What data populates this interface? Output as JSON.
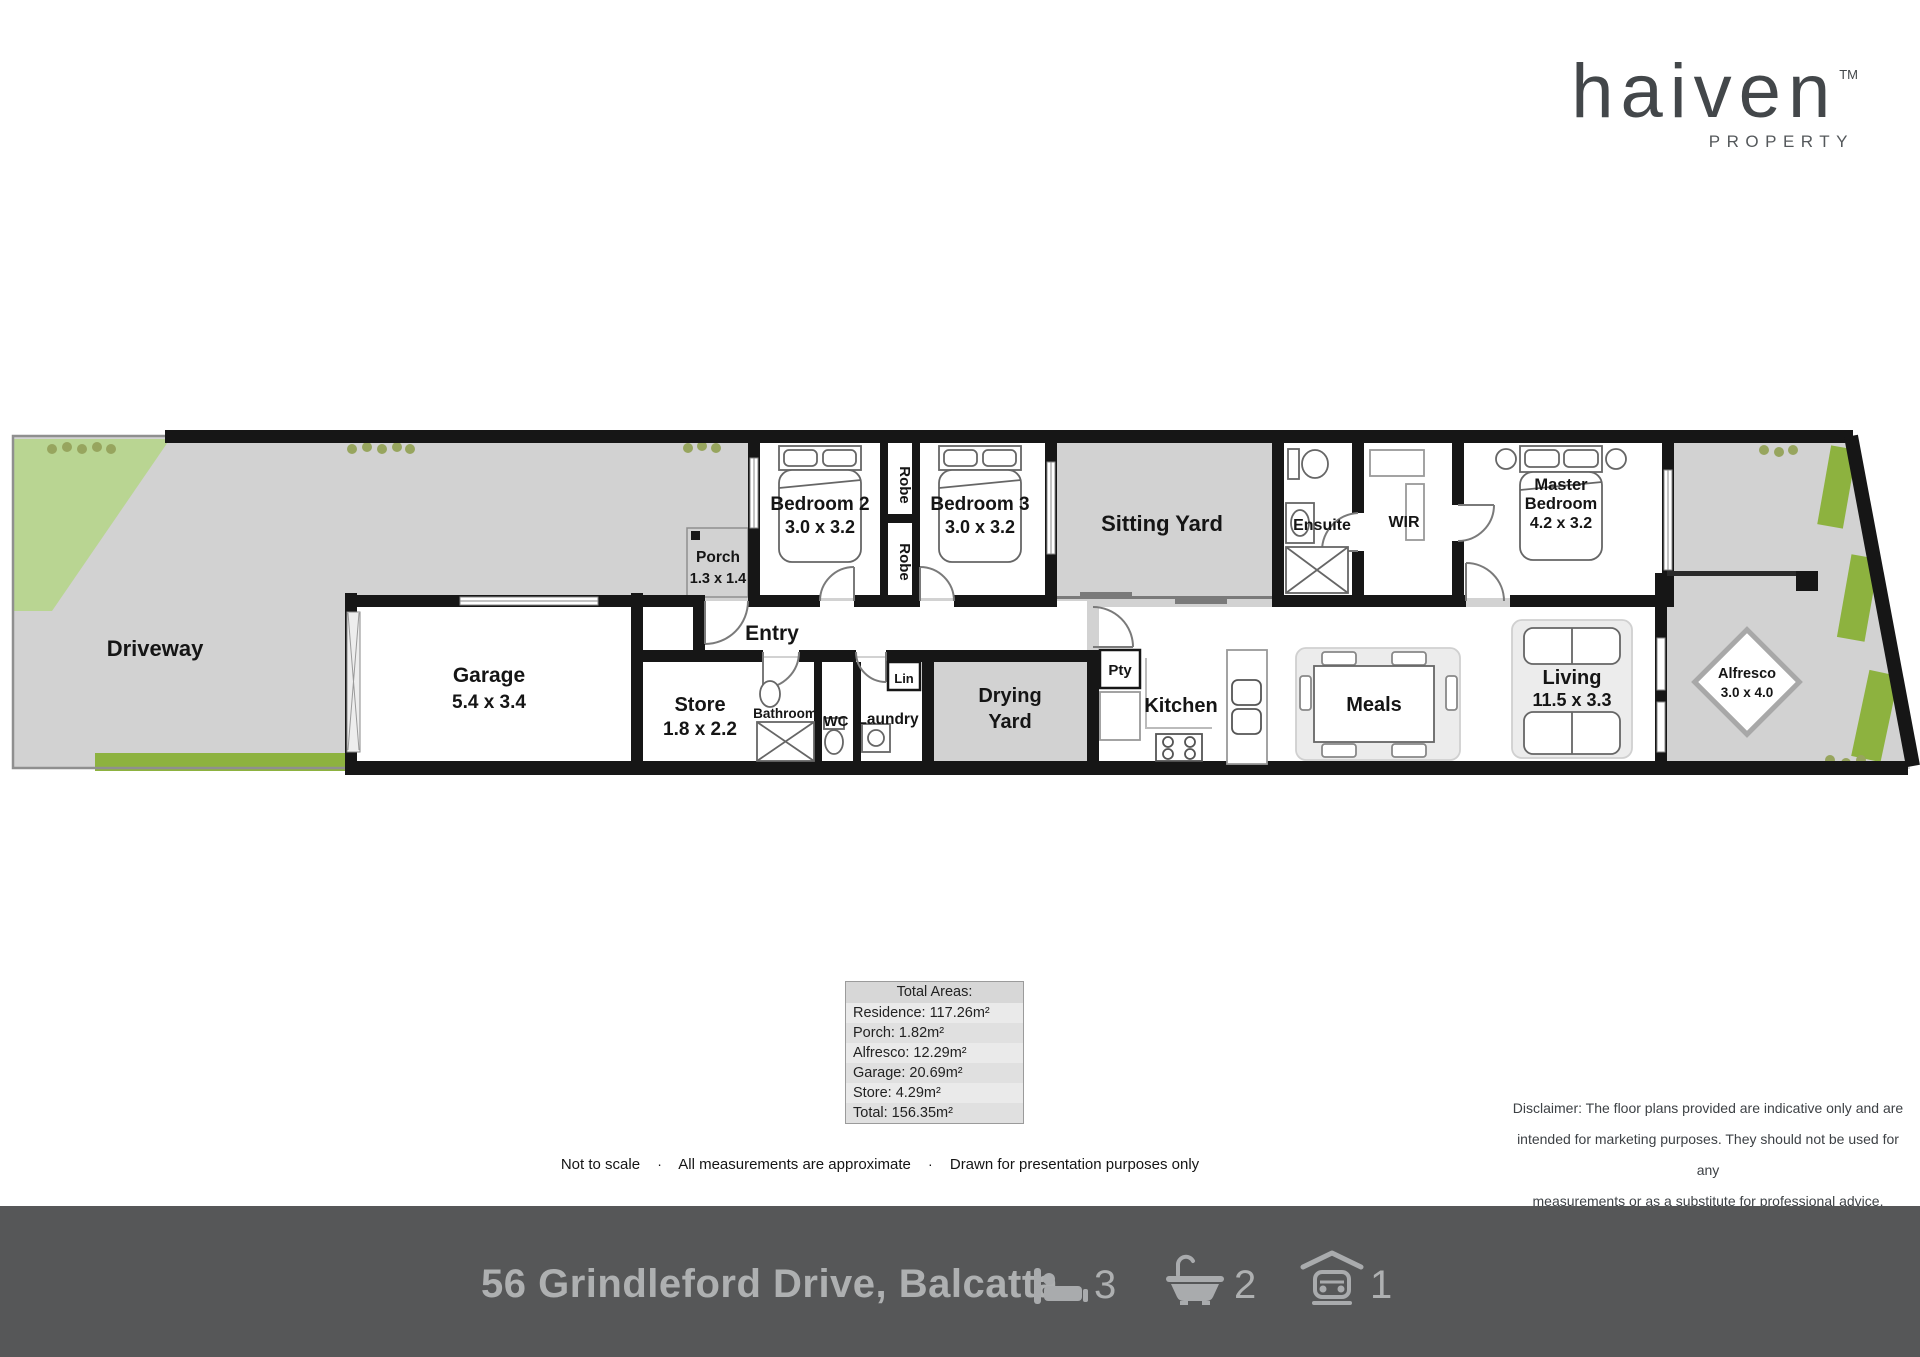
{
  "logo": {
    "brand": "haiven",
    "tm": "TM",
    "subtitle": "PROPERTY"
  },
  "plan": {
    "driveway": "Driveway",
    "garage_name": "Garage",
    "garage_dims": "5.4 x 3.4",
    "store_name": "Store",
    "store_dims": "1.8 x 2.2",
    "porch_name": "Porch",
    "porch_dims": "1.3 x 1.4",
    "entry": "Entry",
    "bedroom2_name": "Bedroom 2",
    "bedroom2_dims": "3.0 x 3.2",
    "bedroom3_name": "Bedroom 3",
    "bedroom3_dims": "3.0 x 3.2",
    "robe1": "Robe",
    "robe2": "Robe",
    "sitting_yard": "Sitting Yard",
    "bathroom": "Bathroom",
    "wc": "WC",
    "laundry": "Laundry",
    "lin": "Lin",
    "drying_line1": "Drying",
    "drying_line2": "Yard",
    "pty": "Pty",
    "kitchen": "Kitchen",
    "meals": "Meals",
    "living_name": "Living",
    "living_dims": "11.5 x 3.3",
    "ensuite": "Ensuite",
    "wir": "WIR",
    "master_line1": "Master",
    "master_line2": "Bedroom",
    "master_dims": "4.2 x 3.2",
    "alfresco_name": "Alfresco",
    "alfresco_dims": "3.0 x 4.0"
  },
  "areas": {
    "title": "Total Areas:",
    "rows": [
      "Residence: 117.26m²",
      "Porch: 1.82m²",
      "Alfresco: 12.29m²",
      "Garage: 20.69m²",
      "Store: 4.29m²",
      "Total: 156.35m²"
    ]
  },
  "notes": {
    "sep": "·",
    "items": [
      "Not to scale",
      "All measurements are approximate",
      "Drawn for presentation purposes only"
    ]
  },
  "disclaimer": {
    "line1": "Disclaimer: The floor plans provided are indicative only and are",
    "line2": "intended for marketing purposes. They should not be used for any",
    "line3": "measurements or as a substitute for professional advice."
  },
  "footer": {
    "address": "56 Grindleford Drive, Balcatta",
    "beds": "3",
    "baths": "2",
    "cars": "1"
  },
  "colors": {
    "wall": "#161616",
    "outdoor": "#d2d2d2",
    "lawn": "#b9d592",
    "hedge": "#8db23f",
    "footer_bg": "#565758",
    "footer_fg": "#aeb0b1",
    "logo_fg": "#43474a"
  }
}
